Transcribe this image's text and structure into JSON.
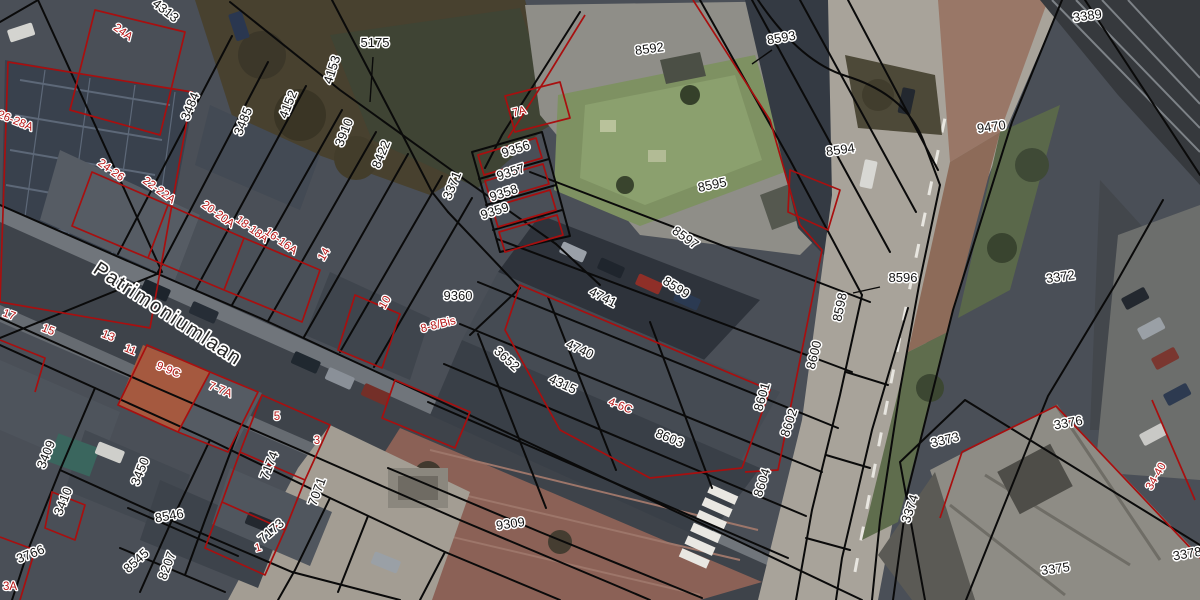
{
  "map": {
    "type": "cadastral-aerial-map",
    "street_name": "Patrimoniumlaan",
    "colors": {
      "parcel_line": "#0a0a0a",
      "building_outline": "#a80f0f",
      "parcel_label": "#151515",
      "address_label": "#b51414",
      "label_halo": "#ffffff"
    }
  },
  "labels": [
    {
      "text": "4313",
      "x": 163,
      "y": 14,
      "rot": 38,
      "kind": "parcel"
    },
    {
      "text": "3484",
      "x": 194,
      "y": 108,
      "rot": -68,
      "kind": "parcel"
    },
    {
      "text": "3485",
      "x": 247,
      "y": 123,
      "rot": -68,
      "kind": "parcel"
    },
    {
      "text": "4152",
      "x": 292,
      "y": 106,
      "rot": -68,
      "kind": "parcel"
    },
    {
      "text": "4153",
      "x": 336,
      "y": 71,
      "rot": -72,
      "kind": "parcel"
    },
    {
      "text": "3910",
      "x": 348,
      "y": 134,
      "rot": -68,
      "kind": "parcel"
    },
    {
      "text": "8422",
      "x": 385,
      "y": 156,
      "rot": -68,
      "kind": "parcel"
    },
    {
      "text": "3371",
      "x": 456,
      "y": 187,
      "rot": -68,
      "kind": "parcel"
    },
    {
      "text": "5175",
      "x": 375,
      "y": 47,
      "rot": 0,
      "kind": "parcel"
    },
    {
      "text": "8592",
      "x": 650,
      "y": 53,
      "rot": -8,
      "kind": "parcel"
    },
    {
      "text": "8593",
      "x": 782,
      "y": 42,
      "rot": -10,
      "kind": "parcel"
    },
    {
      "text": "8594",
      "x": 841,
      "y": 154,
      "rot": -8,
      "kind": "parcel"
    },
    {
      "text": "9470",
      "x": 992,
      "y": 131,
      "rot": -8,
      "kind": "parcel"
    },
    {
      "text": "3389",
      "x": 1088,
      "y": 20,
      "rot": -8,
      "kind": "parcel"
    },
    {
      "text": "8595",
      "x": 713,
      "y": 189,
      "rot": -12,
      "kind": "parcel"
    },
    {
      "text": "9356",
      "x": 517,
      "y": 153,
      "rot": -18,
      "kind": "parcel"
    },
    {
      "text": "9357",
      "x": 512,
      "y": 176,
      "rot": -18,
      "kind": "parcel"
    },
    {
      "text": "9358",
      "x": 505,
      "y": 197,
      "rot": -18,
      "kind": "parcel"
    },
    {
      "text": "9359",
      "x": 496,
      "y": 215,
      "rot": -18,
      "kind": "parcel"
    },
    {
      "text": "9360",
      "x": 458,
      "y": 300,
      "rot": 0,
      "kind": "parcel"
    },
    {
      "text": "8596",
      "x": 903,
      "y": 282,
      "rot": 0,
      "kind": "parcel"
    },
    {
      "text": "8597",
      "x": 683,
      "y": 241,
      "rot": 36,
      "kind": "parcel"
    },
    {
      "text": "8599",
      "x": 674,
      "y": 291,
      "rot": 33,
      "kind": "parcel"
    },
    {
      "text": "4741",
      "x": 601,
      "y": 301,
      "rot": 27,
      "kind": "parcel"
    },
    {
      "text": "4740",
      "x": 578,
      "y": 353,
      "rot": 25,
      "kind": "parcel"
    },
    {
      "text": "4315",
      "x": 561,
      "y": 388,
      "rot": 25,
      "kind": "parcel"
    },
    {
      "text": "3652",
      "x": 504,
      "y": 362,
      "rot": 42,
      "kind": "parcel"
    },
    {
      "text": "8603",
      "x": 668,
      "y": 442,
      "rot": 22,
      "kind": "parcel"
    },
    {
      "text": "8601",
      "x": 766,
      "y": 398,
      "rot": -74,
      "kind": "parcel"
    },
    {
      "text": "8602",
      "x": 793,
      "y": 424,
      "rot": -72,
      "kind": "parcel"
    },
    {
      "text": "8604",
      "x": 766,
      "y": 484,
      "rot": -72,
      "kind": "parcel"
    },
    {
      "text": "8600",
      "x": 818,
      "y": 356,
      "rot": -76,
      "kind": "parcel"
    },
    {
      "text": "8598",
      "x": 844,
      "y": 308,
      "rot": -78,
      "kind": "parcel"
    },
    {
      "text": "9309",
      "x": 511,
      "y": 528,
      "rot": -8,
      "kind": "parcel"
    },
    {
      "text": "3372",
      "x": 1061,
      "y": 281,
      "rot": -8,
      "kind": "parcel"
    },
    {
      "text": "3373",
      "x": 946,
      "y": 444,
      "rot": -14,
      "kind": "parcel"
    },
    {
      "text": "3376",
      "x": 1069,
      "y": 427,
      "rot": -10,
      "kind": "parcel"
    },
    {
      "text": "3374",
      "x": 914,
      "y": 510,
      "rot": -72,
      "kind": "parcel"
    },
    {
      "text": "3375",
      "x": 1056,
      "y": 573,
      "rot": -8,
      "kind": "parcel"
    },
    {
      "text": "3378",
      "x": 1188,
      "y": 558,
      "rot": -10,
      "kind": "parcel"
    },
    {
      "text": "3409",
      "x": 50,
      "y": 456,
      "rot": -68,
      "kind": "parcel"
    },
    {
      "text": "3410",
      "x": 67,
      "y": 503,
      "rot": -68,
      "kind": "parcel"
    },
    {
      "text": "3450",
      "x": 144,
      "y": 473,
      "rot": -68,
      "kind": "parcel"
    },
    {
      "text": "8546",
      "x": 170,
      "y": 520,
      "rot": -10,
      "kind": "parcel"
    },
    {
      "text": "8545",
      "x": 139,
      "y": 564,
      "rot": -42,
      "kind": "parcel"
    },
    {
      "text": "8207",
      "x": 171,
      "y": 567,
      "rot": -70,
      "kind": "parcel"
    },
    {
      "text": "3766",
      "x": 32,
      "y": 558,
      "rot": -22,
      "kind": "parcel"
    },
    {
      "text": "7174",
      "x": 273,
      "y": 467,
      "rot": -68,
      "kind": "parcel"
    },
    {
      "text": "7071",
      "x": 321,
      "y": 493,
      "rot": -70,
      "kind": "parcel"
    },
    {
      "text": "7173",
      "x": 274,
      "y": 534,
      "rot": -40,
      "kind": "parcel"
    },
    {
      "text": "24A",
      "x": 121,
      "y": 35,
      "rot": 36,
      "kind": "address"
    },
    {
      "text": "26-28A",
      "x": 14,
      "y": 124,
      "rot": 22,
      "kind": "address"
    },
    {
      "text": "24-26",
      "x": 109,
      "y": 173,
      "rot": 36,
      "kind": "address"
    },
    {
      "text": "22-22A",
      "x": 157,
      "y": 193,
      "rot": 36,
      "kind": "address"
    },
    {
      "text": "20-20A",
      "x": 216,
      "y": 217,
      "rot": 36,
      "kind": "address"
    },
    {
      "text": "18-18A",
      "x": 250,
      "y": 232,
      "rot": 36,
      "kind": "address"
    },
    {
      "text": "16-16A",
      "x": 279,
      "y": 244,
      "rot": 36,
      "kind": "address"
    },
    {
      "text": "17",
      "x": 8,
      "y": 318,
      "rot": 20,
      "kind": "address"
    },
    {
      "text": "15",
      "x": 47,
      "y": 333,
      "rot": 22,
      "kind": "address"
    },
    {
      "text": "13",
      "x": 107,
      "y": 339,
      "rot": 22,
      "kind": "address"
    },
    {
      "text": "11",
      "x": 129,
      "y": 353,
      "rot": 22,
      "kind": "address"
    },
    {
      "text": "9-9C",
      "x": 167,
      "y": 373,
      "rot": 22,
      "kind": "address"
    },
    {
      "text": "7-7A",
      "x": 219,
      "y": 393,
      "rot": 22,
      "kind": "address"
    },
    {
      "text": "5",
      "x": 277,
      "y": 420,
      "rot": 0,
      "kind": "address"
    },
    {
      "text": "3",
      "x": 317,
      "y": 444,
      "rot": 0,
      "kind": "address"
    },
    {
      "text": "1",
      "x": 259,
      "y": 551,
      "rot": -15,
      "kind": "address"
    },
    {
      "text": "3A",
      "x": 10,
      "y": 590,
      "rot": 0,
      "kind": "address"
    },
    {
      "text": "14",
      "x": 327,
      "y": 256,
      "rot": -60,
      "kind": "address"
    },
    {
      "text": "10",
      "x": 388,
      "y": 304,
      "rot": -60,
      "kind": "address"
    },
    {
      "text": "8-8/Bis",
      "x": 439,
      "y": 328,
      "rot": -14,
      "kind": "address"
    },
    {
      "text": "7A",
      "x": 520,
      "y": 115,
      "rot": -14,
      "kind": "address"
    },
    {
      "text": "4-6C",
      "x": 619,
      "y": 409,
      "rot": 22,
      "kind": "address"
    },
    {
      "text": "34-40",
      "x": 1159,
      "y": 478,
      "rot": -60,
      "kind": "address"
    },
    {
      "text": "Patrimoniumlaan",
      "x": 92,
      "y": 272,
      "rot": 33,
      "kind": "street"
    }
  ]
}
